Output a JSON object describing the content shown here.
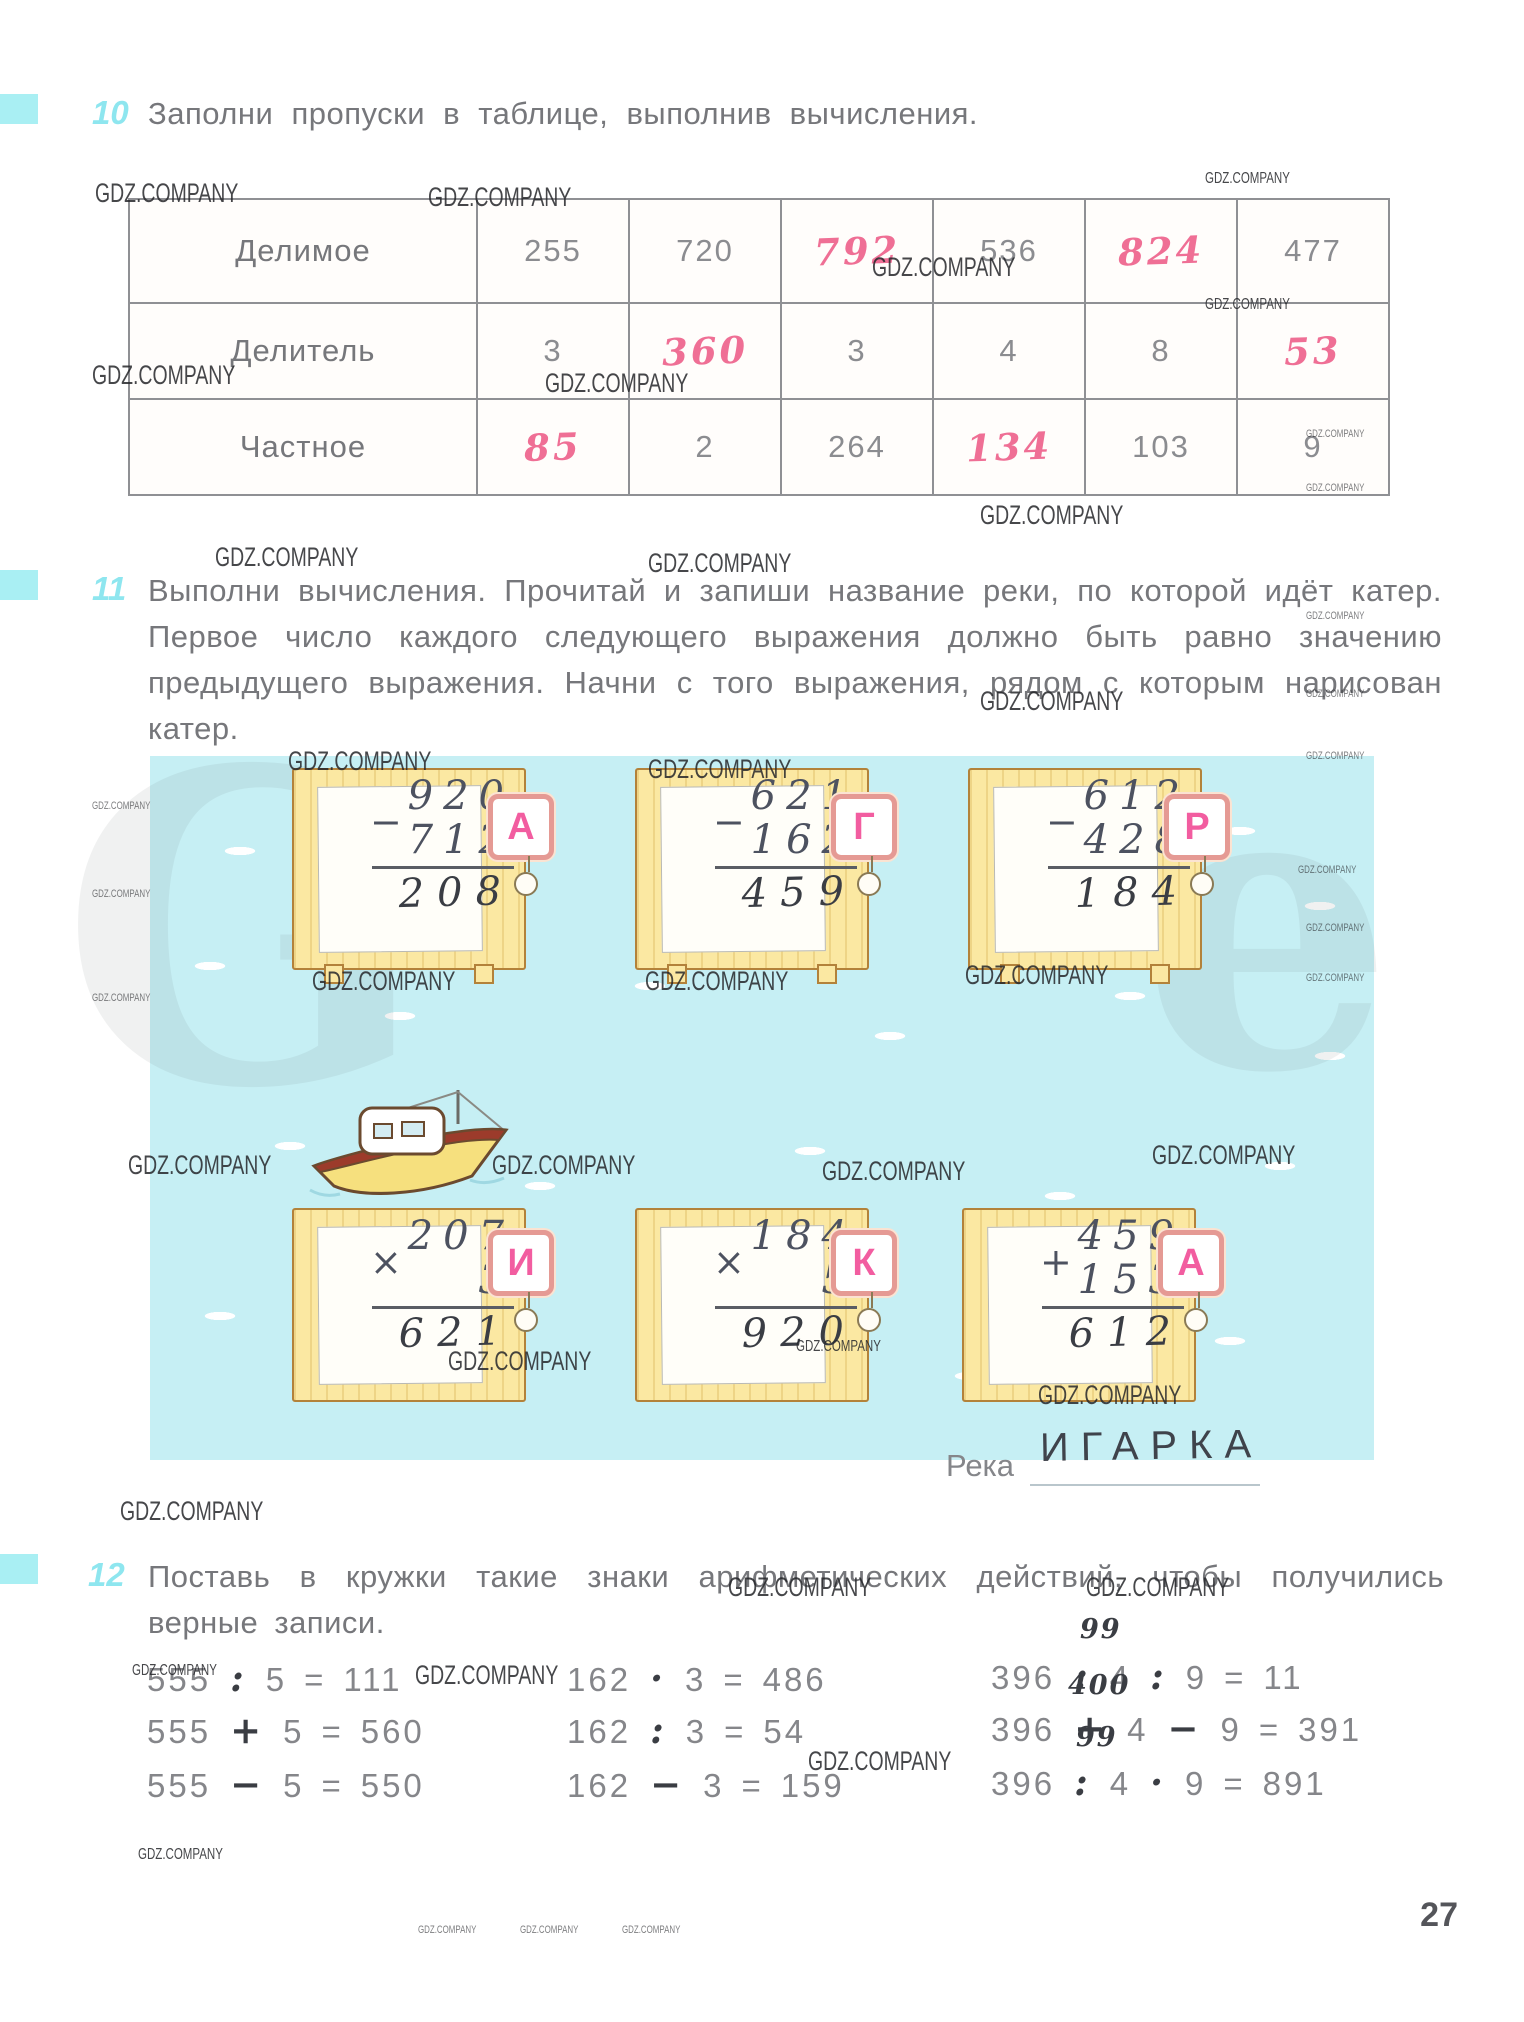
{
  "wm": "GDZ.COMPANY",
  "page_number": "27",
  "ghosts": [
    "G",
    "e"
  ],
  "colors": {
    "accent_cyan": "#8ee6ef",
    "handwriting_pink": "#ef6f95",
    "handwriting_pencil": "#3a3d43",
    "water": "#c6eff4",
    "card_yellow": "#fbe8a2",
    "tab_letter_pink": "#f25da0"
  },
  "problem10": {
    "number": "10",
    "title": "Заполни пропуски в таблице, выполнив вычисления.",
    "table": {
      "rows": [
        {
          "label": "Делимое",
          "cells": [
            {
              "v": "255",
              "handwritten": false
            },
            {
              "v": "720",
              "handwritten": false
            },
            {
              "v": "792",
              "handwritten": true
            },
            {
              "v": "536",
              "handwritten": false
            },
            {
              "v": "824",
              "handwritten": true
            },
            {
              "v": "477",
              "handwritten": false
            }
          ]
        },
        {
          "label": "Делитель",
          "cells": [
            {
              "v": "3",
              "handwritten": false
            },
            {
              "v": "360",
              "handwritten": true
            },
            {
              "v": "3",
              "handwritten": false
            },
            {
              "v": "4",
              "handwritten": false
            },
            {
              "v": "8",
              "handwritten": false
            },
            {
              "v": "53",
              "handwritten": true
            }
          ]
        },
        {
          "label": "Частное",
          "cells": [
            {
              "v": "85",
              "handwritten": true
            },
            {
              "v": "2",
              "handwritten": false
            },
            {
              "v": "264",
              "handwritten": false
            },
            {
              "v": "134",
              "handwritten": true
            },
            {
              "v": "103",
              "handwritten": false
            },
            {
              "v": "9",
              "handwritten": false
            }
          ]
        }
      ]
    }
  },
  "problem11": {
    "number": "11",
    "text": "Выполни вычисления. Прочитай и запиши название реки, по которой идёт катер. Первое число каждого следующего выражения должно быть равно значению предыдущего выражения. Начни с того выражения, рядом с которым нарисован катер.",
    "cards": [
      {
        "letter": "А",
        "op": "−",
        "top": "920",
        "bottom": "712",
        "result": "208"
      },
      {
        "letter": "Г",
        "op": "−",
        "top": "621",
        "bottom": "162",
        "result": "459"
      },
      {
        "letter": "Р",
        "op": "−",
        "top": "612",
        "bottom": "428",
        "result": "184"
      },
      {
        "letter": "И",
        "op": "×",
        "top": "207",
        "bottom": "3",
        "result": "621"
      },
      {
        "letter": "К",
        "op": "×",
        "top": "184",
        "bottom": "5",
        "result": "920"
      },
      {
        "letter": "А",
        "op": "+",
        "top": "459",
        "bottom": "153",
        "result": "612"
      }
    ],
    "river_label": "Река",
    "river_answer": "ИГАРКА"
  },
  "problem12": {
    "number": "12",
    "title": "Поставь в кружки такие знаки арифметических действий, чтобы получились верные записи.",
    "equals": "=",
    "expressions": [
      {
        "a": "555",
        "op1": ":",
        "b": "5",
        "result": "111"
      },
      {
        "a": "555",
        "op1": "+",
        "b": "5",
        "result": "560"
      },
      {
        "a": "555",
        "op1": "−",
        "b": "5",
        "result": "550"
      },
      {
        "a": "162",
        "op1": "·",
        "b": "3",
        "result": "486"
      },
      {
        "a": "162",
        "op1": ":",
        "b": "3",
        "result": "54"
      },
      {
        "a": "162",
        "op1": "−",
        "b": "3",
        "result": "159"
      },
      {
        "a": "396",
        "op1": ":",
        "b": "4",
        "op2": ":",
        "c": "9",
        "result": "11",
        "note": "99"
      },
      {
        "a": "396",
        "op1": "+",
        "b": "4",
        "op2": "−",
        "c": "9",
        "result": "391",
        "note": "400"
      },
      {
        "a": "396",
        "op1": ":",
        "b": "4",
        "op2": "·",
        "c": "9",
        "result": "891",
        "note": "99"
      }
    ]
  }
}
